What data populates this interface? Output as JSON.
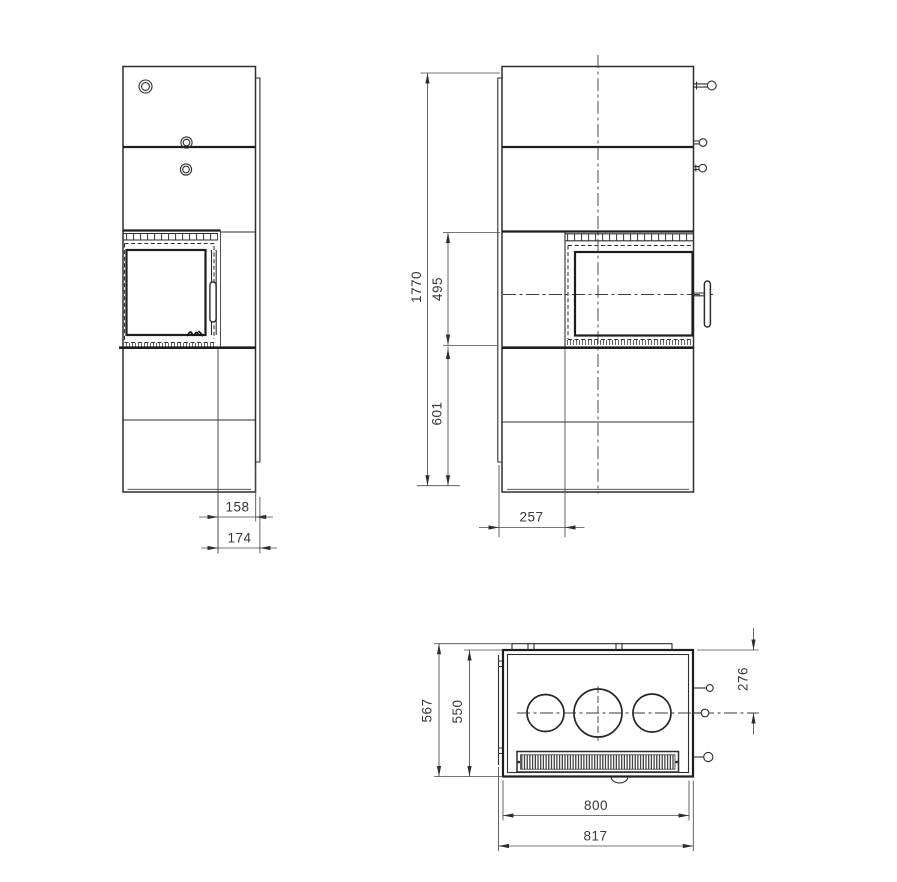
{
  "drawing": {
    "type": "technical-orthographic-views",
    "background_color": "#ffffff",
    "line_color": "#2e2e2e"
  },
  "dimensions": {
    "total_height": "1770",
    "firebox_section_height": "495",
    "base_section_height": "601",
    "door_offset_front": "257",
    "glass_inset_side": "158",
    "door_inset_side": "174",
    "total_depth": "567",
    "body_depth": "550",
    "control_offset": "276",
    "body_width": "800",
    "total_width": "817"
  }
}
